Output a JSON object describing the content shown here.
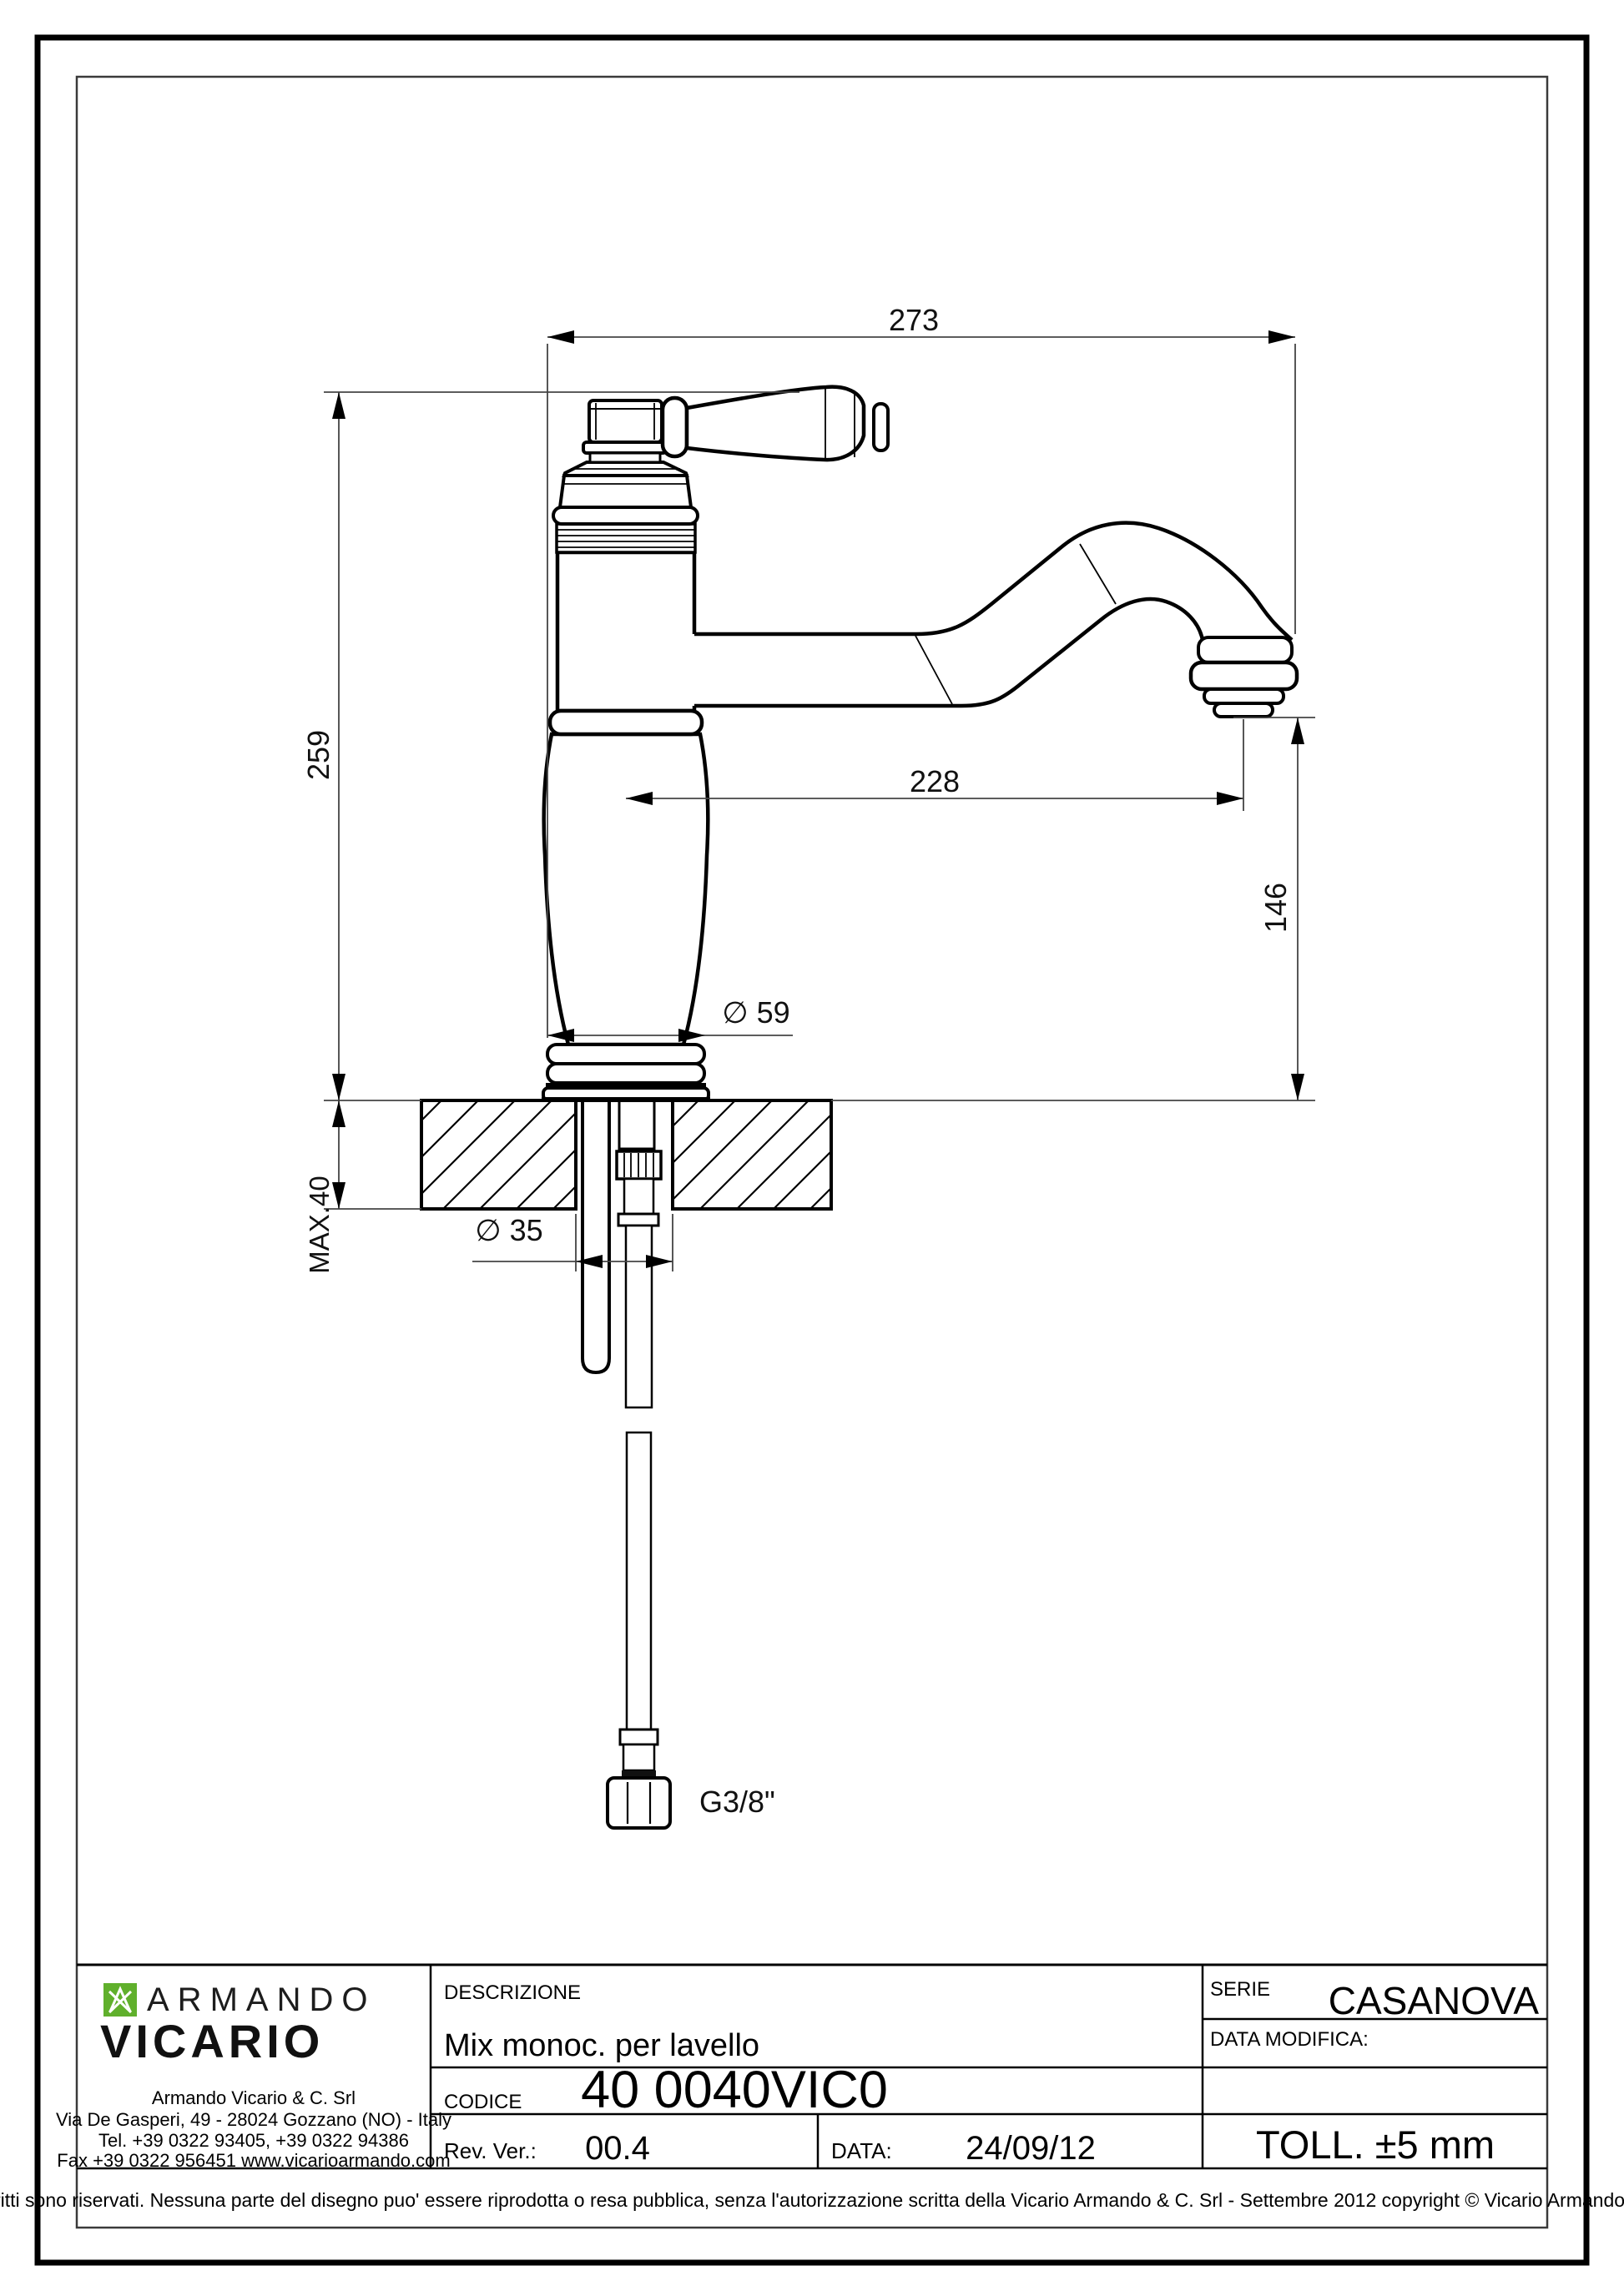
{
  "dims": {
    "total_width": "273",
    "total_height": "259",
    "spout_reach": "228",
    "spout_height": "146",
    "base_diameter": "∅ 59",
    "hole_diameter": "∅ 35",
    "max_counter": "MAX.40",
    "supply_thread": "G3/8\""
  },
  "title_block": {
    "descrizione_label": "DESCRIZIONE",
    "descrizione_value": "Mix monoc. per lavello",
    "codice_label": "CODICE",
    "codice_value": "40 0040VIC0",
    "rev_label": "Rev. Ver.:",
    "rev_value": "00.4",
    "data_label": "DATA:",
    "data_value": "24/09/12",
    "serie_label": "SERIE",
    "serie_value": "CASANOVA",
    "data_modifica_label": "DATA MODIFICA:",
    "toll_value": "TOLL. ±5 mm",
    "logo": {
      "brand_top": "ARMANDO",
      "brand_bottom": "VICARIO",
      "green": "#60b02c"
    },
    "address": [
      "Armando Vicario & C. Srl",
      "Via De Gasperi, 49 - 28024 Gozzano (NO) - Italy",
      "Tel. +39 0322 93405, +39 0322 94386",
      "Fax +39 0322 956451 www.vicarioarmando.com"
    ],
    "disclaimer": "Tutti i diritti sono riservati. Nessuna parte del disegno puo' essere riprodotta o resa pubblica, senza l'autorizzazione scritta della Vicario Armando & C. Srl - Settembre 2012 copyright © Vicario Armando & C. Srl"
  }
}
